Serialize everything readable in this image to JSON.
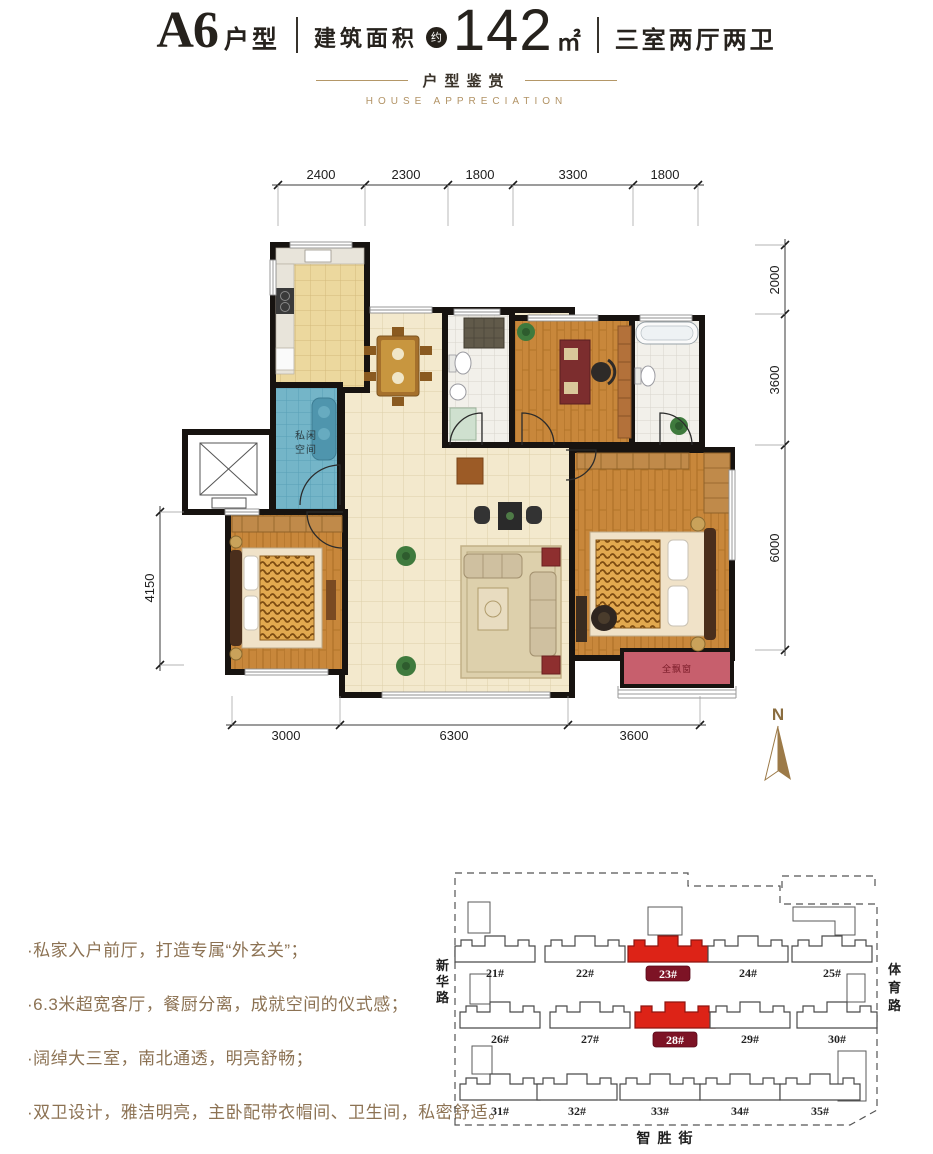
{
  "header": {
    "unit_code": "A6",
    "unit_type_suffix": "户型",
    "area_label": "建筑面积",
    "approx_badge": "约",
    "area_value": "142",
    "area_unit": "㎡",
    "layout_desc": "三室两厅两卫"
  },
  "subtitle": {
    "cn": "户型鉴赏",
    "en": "HOUSE APPRECIATION"
  },
  "plan": {
    "dims_top": [
      "2400",
      "2300",
      "1800",
      "3300",
      "1800"
    ],
    "dims_right": [
      "2000",
      "3600",
      "6000"
    ],
    "dims_left": [
      "4150"
    ],
    "dims_bottom": [
      "3000",
      "6300",
      "3600"
    ],
    "labels": {
      "private_space": "私闲空间",
      "bay_window": "全飘窗"
    },
    "north_label": "N"
  },
  "features": {
    "items": [
      "·私家入户前厅，打造专属“外玄关”；",
      "·6.3米超宽客厅，餐厨分离，成就空间的仪式感；",
      "·阔绰大三室，南北通透，明亮舒畅；",
      "·双卫设计，雅洁明亮，主卧配带衣帽间、卫生间，私密舒适。"
    ]
  },
  "sitemap": {
    "roads": {
      "left": "新华路",
      "right": "体育路",
      "bottom": "智胜街"
    },
    "buildings": [
      {
        "label": "21#",
        "highlight": false
      },
      {
        "label": "22#",
        "highlight": false
      },
      {
        "label": "23#",
        "highlight": true
      },
      {
        "label": "24#",
        "highlight": false
      },
      {
        "label": "25#",
        "highlight": false
      },
      {
        "label": "26#",
        "highlight": false
      },
      {
        "label": "27#",
        "highlight": false
      },
      {
        "label": "28#",
        "highlight": true
      },
      {
        "label": "29#",
        "highlight": false
      },
      {
        "label": "30#",
        "highlight": false
      },
      {
        "label": "31#",
        "highlight": false
      },
      {
        "label": "32#",
        "highlight": false
      },
      {
        "label": "33#",
        "highlight": false
      },
      {
        "label": "34#",
        "highlight": false
      },
      {
        "label": "35#",
        "highlight": false
      }
    ],
    "highlighted": [
      "23#",
      "28#"
    ]
  },
  "colors": {
    "accent_gold": "#ad9065",
    "highlight_red": "#dd2317",
    "badge_red": "#7d1325",
    "bay_red": "#c75f6d"
  }
}
